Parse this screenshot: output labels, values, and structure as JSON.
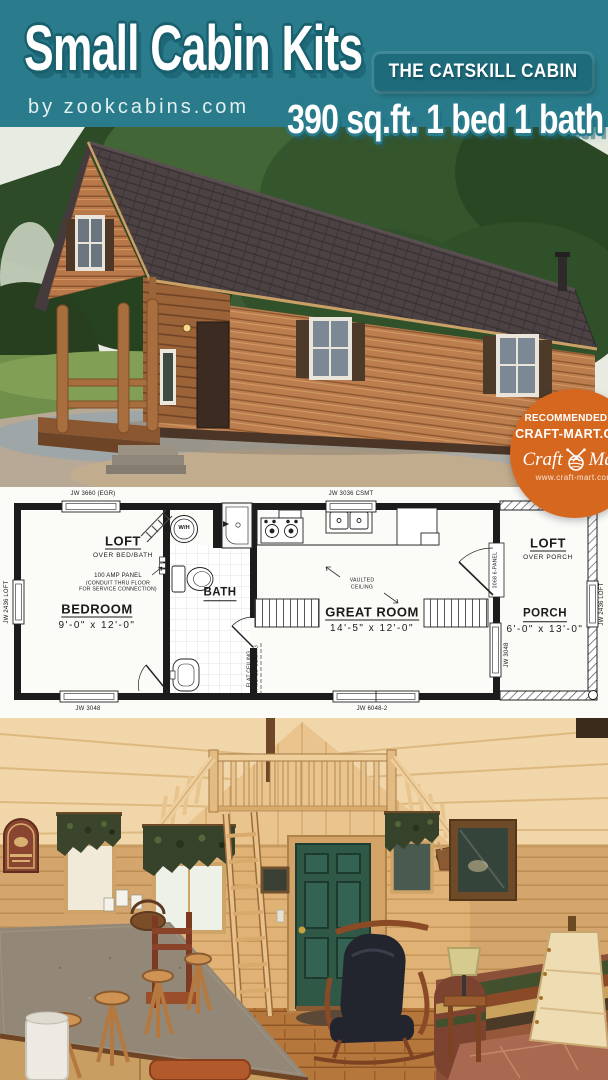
{
  "header": {
    "title": "Small Cabin Kits",
    "byline": "by zookcabins.com",
    "model_name": "THE CATSKILL CABIN",
    "specs": "390 sq.ft. 1 bed 1 bath",
    "teal": "#2a7c8c",
    "banner_teal": "#1e6b7b"
  },
  "badge": {
    "recommended_by": "RECOMMENDED BY",
    "site": "CRAFT-MART.COM",
    "logo_craft": "Craft",
    "logo_mart": "Mart",
    "website": "www.craft-mart.com",
    "orange": "#d6671f"
  },
  "floor_plan": {
    "rooms": {
      "loft_left": {
        "name": "LOFT",
        "subtitle": "OVER BED/BATH"
      },
      "bedroom": {
        "name": "BEDROOM",
        "dims": "9'-0\" x 12'-0\""
      },
      "bath": {
        "name": "BATH"
      },
      "great_room": {
        "name": "GREAT ROOM",
        "dims": "14'-5\" x 12'-0\""
      },
      "loft_right": {
        "name": "LOFT",
        "subtitle": "OVER PORCH"
      },
      "porch": {
        "name": "PORCH",
        "dims": "6'-0\" x 13'-0\""
      }
    },
    "labels": {
      "window_top_left": "JW 3660 (EGR)",
      "window_top_center": "JW 3036 CSMT",
      "window_left": "JW 2436 LOFT",
      "window_bottom_left": "JW 3048",
      "window_bottom_center": "JW 6048-2",
      "window_right_wall": "JW 3048",
      "window_porch_right": "JW 2436 LOFT",
      "entry_door": "3068 6-PANEL",
      "water_heater": "W/H",
      "panel_title": "100 AMP PANEL",
      "panel_sub1": "(CONDUIT THRU FLOOR",
      "panel_sub2": "FOR SERVICE CONNECTION)",
      "vaulted1": "VAULTED",
      "vaulted2": "CEILING",
      "ceiling_flat": "FLAT CEILING",
      "ceiling_vaulted": "VAULTED CEILING"
    }
  }
}
